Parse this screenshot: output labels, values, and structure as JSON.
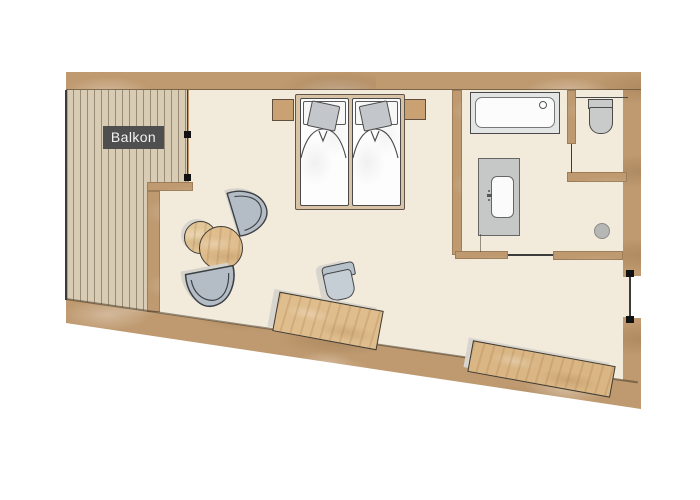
{
  "plan": {
    "type": "hotel-room-floor-plan",
    "balcony_label": "Balkon",
    "rooms": [
      "balcony",
      "bedroom-living-area",
      "bathroom",
      "wc"
    ],
    "elements": [
      "balcony-deck",
      "balcony-door",
      "double-bed",
      "pillow",
      "nightstand-left",
      "nightstand-right",
      "bathtub",
      "toilet",
      "vanity-sink",
      "shower-drain",
      "bathroom-sliding-door",
      "entrance-door",
      "lounge-chair-upper",
      "lounge-chair-lower",
      "side-table-small",
      "side-table-large",
      "desk",
      "desk-chair",
      "bench"
    ]
  },
  "colors": {
    "wall_wood": "#bf9a70",
    "balcony_deck": "#d8cdb4",
    "floor": "#f2ebdc",
    "furniture_wood": "#dfbd8d",
    "upholstery": "#b4bdc5",
    "fixture_gray": "#c9cbca",
    "label_bg": "#4f4f4f",
    "label_text": "#f2f2f2",
    "outline": "#3c3c3c"
  }
}
